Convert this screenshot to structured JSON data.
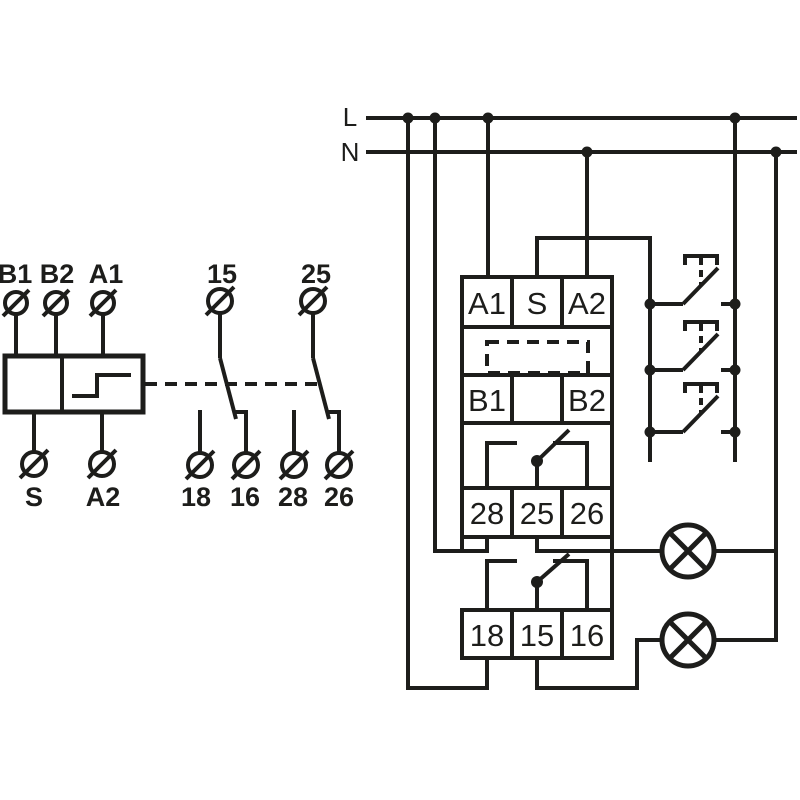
{
  "canvas": {
    "background": "#ffffff",
    "ink": "#1d1d1b"
  },
  "power": {
    "line_label": "L",
    "neutral_label": "N"
  },
  "symbol_block": {
    "top_terminals": [
      "B1",
      "B2",
      "A1"
    ],
    "bottom_terminals": [
      "S",
      "A2"
    ]
  },
  "contact_symbols": {
    "first": {
      "top": "15",
      "bottom_left": "18",
      "bottom_right": "16"
    },
    "second": {
      "top": "25",
      "bottom_left": "28",
      "bottom_right": "26"
    }
  },
  "device": {
    "row1": [
      "A1",
      "S",
      "A2"
    ],
    "row2": [
      "B1",
      "",
      "B2"
    ],
    "row3": [
      "28",
      "25",
      "26"
    ],
    "row4": [
      "18",
      "15",
      "16"
    ]
  },
  "push_buttons": {
    "count": "3"
  },
  "lamps": {
    "count": "2"
  }
}
